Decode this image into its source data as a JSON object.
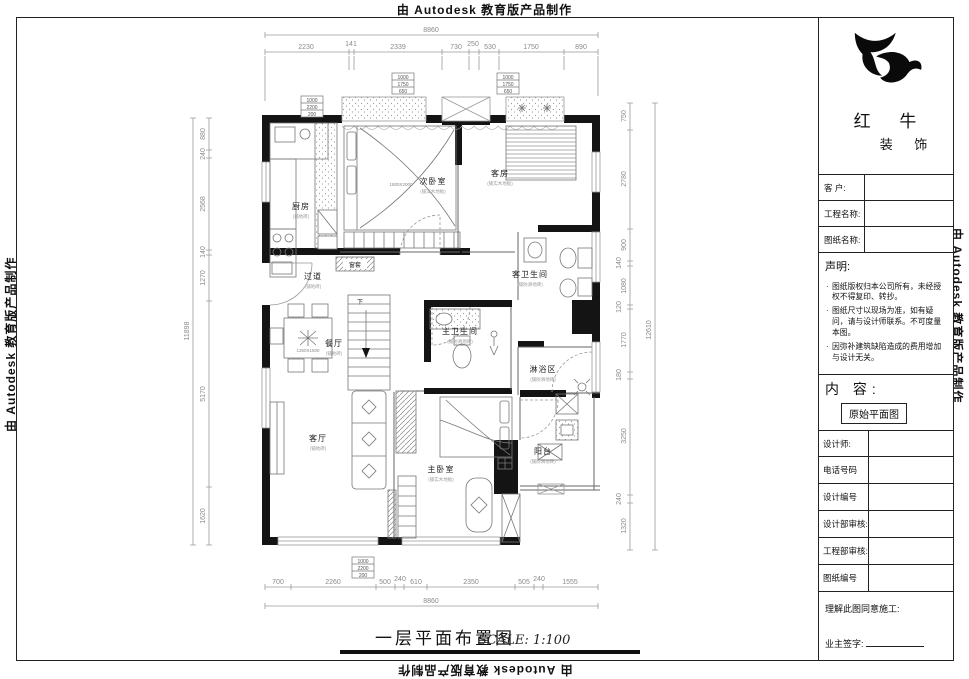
{
  "border_text": {
    "top": "由 Autodesk 教育版产品制作",
    "bottom": "由 Autodesk 教育版产品制作",
    "left": "由 Autodesk 教育版产品制作",
    "right": "由 Autodesk 教育版产品制作"
  },
  "title_block": {
    "logo": {
      "line1": "红 牛",
      "line2": "装 饰"
    },
    "fields": [
      {
        "label": "客  户:",
        "value": ""
      },
      {
        "label": "工程名称:",
        "value": ""
      },
      {
        "label": "图纸名称:",
        "value": ""
      }
    ],
    "statement": {
      "title": "声明:",
      "items": [
        "图纸版权归本公司所有，未经授权不得复印、转抄。",
        "图纸尺寸以现场为准，如有疑问，请与设计师联系。不可度量本图。",
        "因弥补建筑缺陷造成的费用增加与设计无关。"
      ]
    },
    "content": {
      "label": "内 容:",
      "value": "原始平面图"
    },
    "rows": [
      {
        "label": "设计师:",
        "value": ""
      },
      {
        "label": "电话号码",
        "value": ""
      },
      {
        "label": "设计编号",
        "value": ""
      },
      {
        "label": "设计部审核:",
        "value": ""
      },
      {
        "label": "工程部审核:",
        "value": ""
      },
      {
        "label": "图纸编号",
        "value": ""
      }
    ],
    "signature": {
      "line1": "理解此图同意施工:",
      "line2": "业主签字:"
    }
  },
  "plan": {
    "rooms": [
      {
        "name": "厨房",
        "sub": "(铺地砖)"
      },
      {
        "name": "次卧室",
        "sub": "(铺实木地板)"
      },
      {
        "name": "客房",
        "sub": "(铺实木地板)"
      },
      {
        "name": "过道",
        "sub": "(铺地砖)"
      },
      {
        "name": "餐厅",
        "sub": "(铺地砖)"
      },
      {
        "name": "客卫生间",
        "sub": "(铺防滑地砖)"
      },
      {
        "name": "主卫生间",
        "sub": "(铺防滑地砖)"
      },
      {
        "name": "淋浴区",
        "sub": "(铺防滑地砖)"
      },
      {
        "name": "客厅",
        "sub": "(铺地砖)"
      },
      {
        "name": "主卧室",
        "sub": "(铺实木地板)"
      },
      {
        "name": "阳台",
        "sub": "(铺防滑地砖)"
      }
    ],
    "labels": {
      "stair": "下",
      "window_casing": "窗套",
      "bed_size": "1800X2000",
      "table_size": "1350X1500"
    },
    "window_tags": {
      "a": [
        "1000",
        "2200",
        "200"
      ],
      "b": [
        "1000",
        "1750",
        "650"
      ],
      "c": [
        "1000",
        "1750",
        "650"
      ],
      "d": [
        "1000",
        "2200",
        "200"
      ]
    }
  },
  "dims": {
    "top": {
      "overall": "8860",
      "segments": [
        "2230",
        "141",
        "2339",
        "730",
        "250",
        "530",
        "1750",
        "890"
      ]
    },
    "bottom": {
      "overall": "8860",
      "segments": [
        "700",
        "2260",
        "500",
        "240",
        "610",
        "2350",
        "505",
        "240",
        "1555"
      ]
    },
    "left": {
      "overall": "11898",
      "segments": [
        "880",
        "240",
        "2568",
        "140",
        "1270",
        "5170",
        "1620"
      ]
    },
    "right": {
      "overall": "12610",
      "segments": [
        "750",
        "2780",
        "900",
        "140",
        "1080",
        "120",
        "1770",
        "180",
        "3250",
        "240",
        "1320"
      ]
    }
  },
  "footer": {
    "title": "一层平面布置图",
    "scale": "SCALE: 1:100"
  }
}
